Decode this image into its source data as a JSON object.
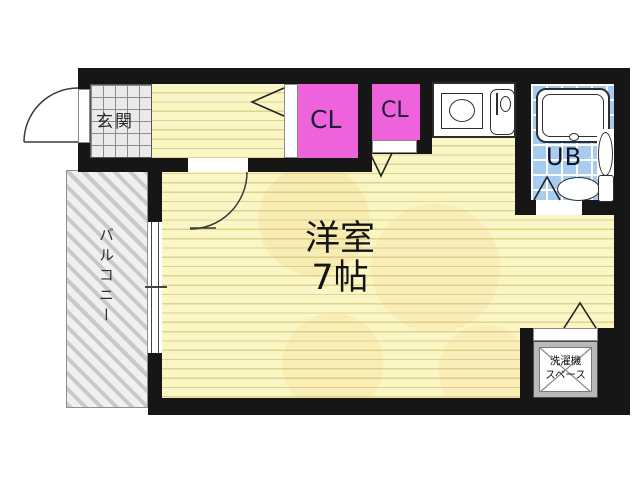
{
  "floorplan": {
    "type": "apartment-floor-plan",
    "rooms": {
      "entrance": {
        "label": "玄関"
      },
      "closet1": {
        "label": "CL"
      },
      "closet2": {
        "label": "CL"
      },
      "main_room": {
        "label": "洋室",
        "size": "7帖"
      },
      "unit_bath": {
        "label": "UB"
      },
      "balcony": {
        "label": "バルコニー"
      },
      "laundry_space": {
        "line1": "洗濯機",
        "line2": "スペース"
      }
    },
    "colors": {
      "wall": "#161616",
      "floor": "#FAF6C5",
      "floor_stripe": "#E6DC9C",
      "closet_pink": "#EE63DC",
      "bath_tile_blue": "#A8CCEF",
      "entrance_tile": "#EAEAEA",
      "balcony_hatch": "#C9C9C9",
      "laundry_gray": "#B9B9B9"
    },
    "fixtures": [
      "entrance-door-swing-icon",
      "room-door-swing-icon",
      "folding-door-icon",
      "window-icon",
      "stove-icon",
      "kitchen-sink-icon",
      "bathtub-icon",
      "washbasin-icon",
      "toilet-icon",
      "laundry-space-cross-icon"
    ]
  }
}
